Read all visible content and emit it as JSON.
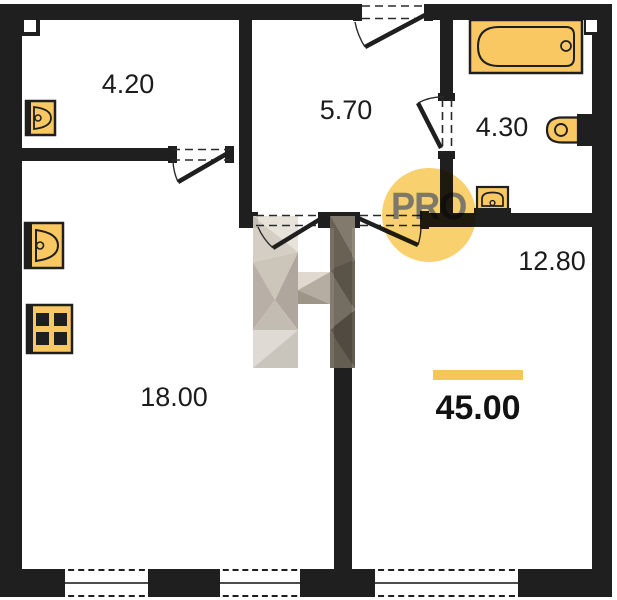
{
  "plan": {
    "rooms": [
      {
        "id": "room-top-left",
        "area_label": "4.20"
      },
      {
        "id": "hallway",
        "area_label": "5.70"
      },
      {
        "id": "bathroom",
        "area_label": "4.30"
      },
      {
        "id": "room-right",
        "area_label": "12.80"
      },
      {
        "id": "kitchen-living-room",
        "area_label": "18.00"
      }
    ],
    "total_area_label": "45.00",
    "watermark": {
      "badge_text": "PRO",
      "logo_letter": "H"
    },
    "fixtures": [
      "sink-icon",
      "kitchen-sink-icon",
      "stove-icon",
      "bathtub-icon",
      "toilet-icon",
      "washbasin-icon"
    ],
    "colors": {
      "wall": "#1f1f1f",
      "fixture_fill": "#f9c863",
      "badge_fill": "#f8d06e",
      "accent_bar": "#f7c55a"
    }
  }
}
